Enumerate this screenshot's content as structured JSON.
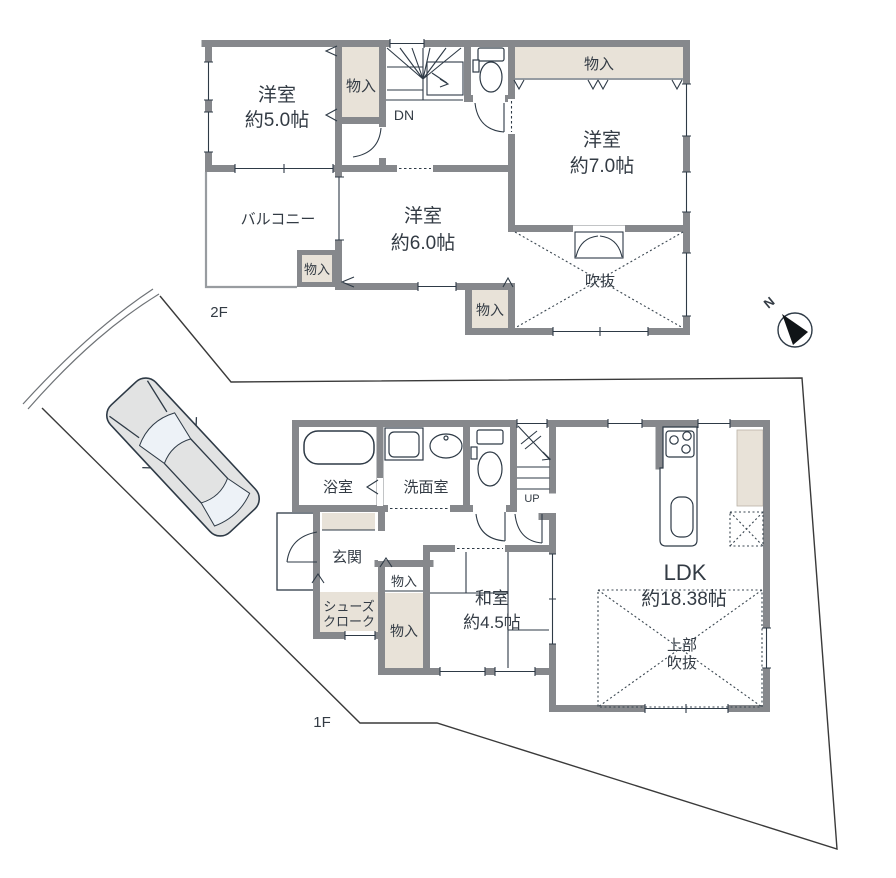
{
  "floor2": {
    "label": "2F",
    "rooms": {
      "west": {
        "name": "洋室",
        "size": "約5.0帖"
      },
      "east": {
        "name": "洋室",
        "size": "約7.0帖"
      },
      "south": {
        "name": "洋室",
        "size": "約6.0帖"
      },
      "balcony": {
        "name": "バルコニー"
      },
      "void": {
        "name": "吹抜"
      }
    },
    "closet_label": "物入",
    "stairs_label": "DN"
  },
  "floor1": {
    "label": "1F",
    "rooms": {
      "bathroom": {
        "name": "浴室"
      },
      "washroom": {
        "name": "洗面室"
      },
      "entrance": {
        "name": "玄関"
      },
      "shoe_closet": {
        "line1": "シューズ",
        "line2": "クローク"
      },
      "japanese": {
        "name": "和室",
        "size": "約4.5帖"
      },
      "ldk": {
        "name": "LDK",
        "size": "約18.38帖"
      },
      "upper_void": {
        "line1": "上部",
        "line2": "吹抜"
      }
    },
    "closet_label": "物入",
    "stairs_label": "UP"
  },
  "compass": {
    "north_label": "N"
  },
  "colors": {
    "wall": "#86888C",
    "closet_fill": "#E8E2D8",
    "fixture_line": "#2E3A46",
    "boundary_line": "#3A3A3A",
    "text": "#333B44"
  }
}
